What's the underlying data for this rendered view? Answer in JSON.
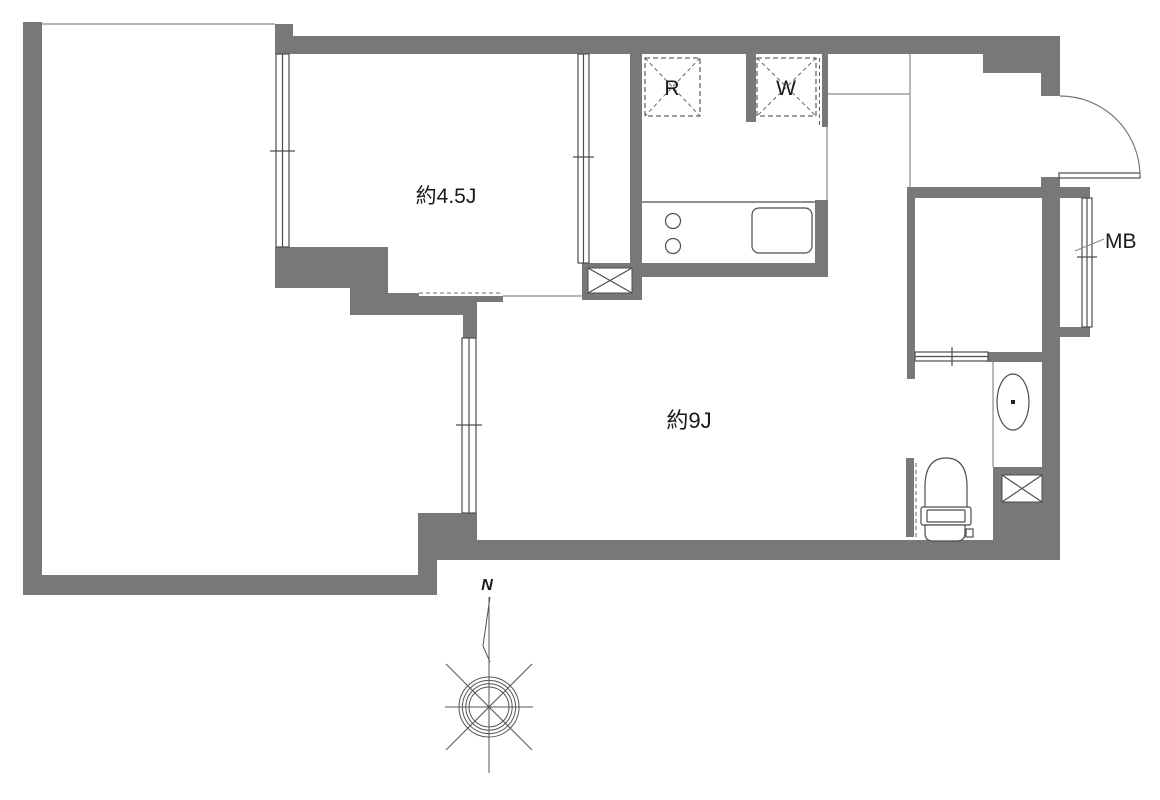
{
  "page": {
    "background": "#ffffff",
    "kind": "apartment-floor-plan"
  },
  "colors": {
    "wall": "#787878",
    "line": "#4d4d4d",
    "dash": "#666666",
    "text": "#1a1a1a",
    "arc": "#777777"
  },
  "labels": {
    "room_45": "約4.5J",
    "room_9": "約9J",
    "refrigerator": "R",
    "washer": "W",
    "meter_box": "MB",
    "north": "N"
  },
  "rooms": [
    {
      "name": "western-room",
      "label": "約4.5J"
    },
    {
      "name": "living-dining-room",
      "label": "約9J"
    }
  ]
}
